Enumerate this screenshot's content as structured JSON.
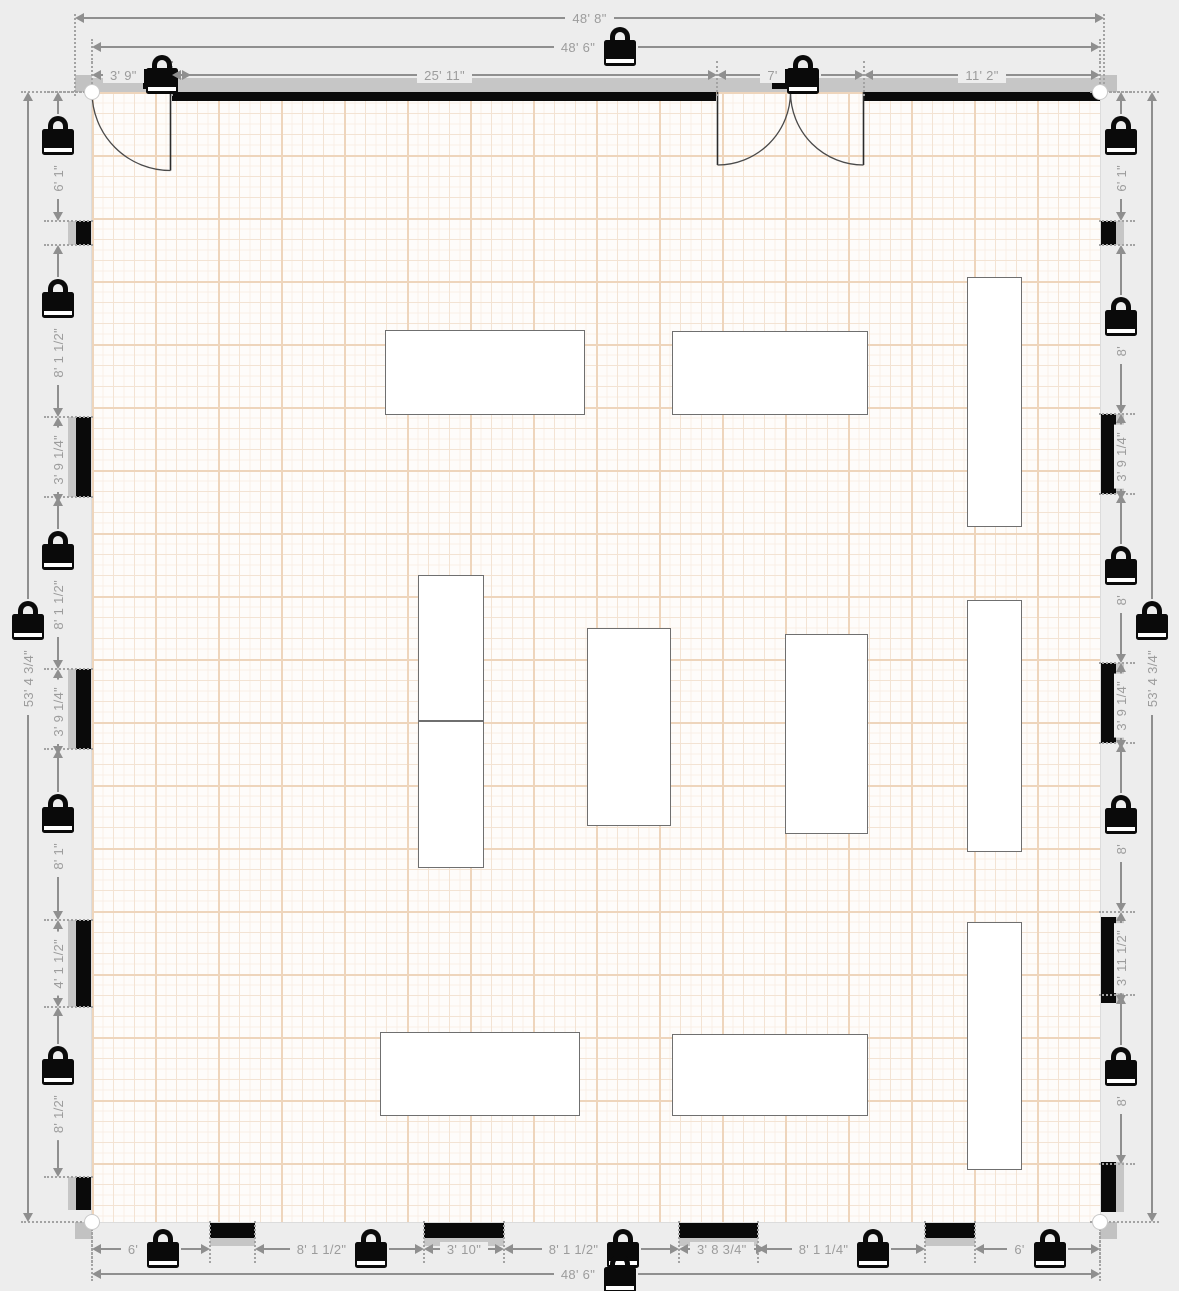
{
  "colors": {
    "background": "#ededed",
    "wall": "#0a0a0a",
    "wall_shadow": "#c6c6c6",
    "dimension_line": "#8f8f8f",
    "dimension_text": "#9c9c9c",
    "floor": "#fefcfa",
    "grid_major": "#eed5bc",
    "grid_minor": "#f3e3d3",
    "grid_fine": "#f9efe7",
    "furniture_fill": "#ffffff",
    "furniture_border": "#6f6f6f",
    "lock_icon": "#0a0a0a"
  },
  "room": {
    "overall_width_outer": "48' 8\"",
    "overall_width_inner": "48' 6\"",
    "overall_height": "53' 4 3/4\"",
    "floor": {
      "x": 92,
      "y": 92,
      "width": 1008,
      "height": 1130
    }
  },
  "dimensions": {
    "top": [
      {
        "label": "48' 8\"",
        "locked": false,
        "a": 75,
        "b": 1104,
        "pos": 18,
        "tick": [
          4,
          78
        ]
      },
      {
        "label": "48' 6\"",
        "locked": true,
        "a": 92,
        "b": 1100,
        "pos": 47,
        "tick": [
          8,
          49
        ]
      },
      {
        "label": "3' 9\"",
        "locked": true,
        "a": 92,
        "b": 172,
        "pos": 75,
        "tick": [
          14,
          21
        ]
      },
      {
        "label": "25' 11\"",
        "locked": false,
        "a": 172,
        "b": 717,
        "pos": 75,
        "tick": [
          14,
          21
        ]
      },
      {
        "label": "7'",
        "locked": true,
        "a": 717,
        "b": 864,
        "pos": 75,
        "tick": [
          14,
          21
        ]
      },
      {
        "label": "11' 2\"",
        "locked": false,
        "a": 864,
        "b": 1100,
        "pos": 75,
        "tick": [
          14,
          21
        ]
      }
    ],
    "bottom": [
      {
        "label": "6'",
        "locked": true,
        "a": 92,
        "b": 210,
        "pos": 1249,
        "tick": [
          28,
          14
        ]
      },
      {
        "label": "8' 1 1/2\"",
        "locked": true,
        "a": 255,
        "b": 424,
        "pos": 1249,
        "tick": [
          28,
          14
        ]
      },
      {
        "label": "3' 10\"",
        "locked": false,
        "a": 424,
        "b": 504,
        "pos": 1249,
        "tick": [
          28,
          14
        ]
      },
      {
        "label": "8' 1 1/2\"",
        "locked": true,
        "a": 504,
        "b": 679,
        "pos": 1249,
        "tick": [
          28,
          14
        ]
      },
      {
        "label": "3' 8 3/4\"",
        "locked": false,
        "a": 679,
        "b": 758,
        "pos": 1249,
        "tick": [
          28,
          14
        ]
      },
      {
        "label": "8' 1 1/4\"",
        "locked": true,
        "a": 758,
        "b": 925,
        "pos": 1249,
        "tick": [
          28,
          14
        ]
      },
      {
        "label": "6'",
        "locked": true,
        "a": 975,
        "b": 1100,
        "pos": 1249,
        "tick": [
          28,
          14
        ]
      },
      {
        "label": "48' 6\"",
        "locked": true,
        "a": 92,
        "b": 1100,
        "pos": 1274,
        "tick": [
          53,
          7
        ]
      }
    ],
    "left": [
      {
        "label": "6' 1\"",
        "locked": true,
        "a": 92,
        "b": 221,
        "pos": 58,
        "tick": [
          14,
          35
        ]
      },
      {
        "label": "8' 1 1/2\"",
        "locked": true,
        "a": 245,
        "b": 417,
        "pos": 58,
        "tick": [
          14,
          35
        ]
      },
      {
        "label": "3' 9 1/4\"",
        "locked": false,
        "a": 417,
        "b": 497,
        "pos": 58,
        "tick": [
          14,
          35
        ]
      },
      {
        "label": "8' 1 1/2\"",
        "locked": true,
        "a": 497,
        "b": 669,
        "pos": 58,
        "tick": [
          14,
          35
        ]
      },
      {
        "label": "3' 9 1/4\"",
        "locked": false,
        "a": 669,
        "b": 749,
        "pos": 58,
        "tick": [
          14,
          35
        ]
      },
      {
        "label": "8' 1\"",
        "locked": true,
        "a": 749,
        "b": 920,
        "pos": 58,
        "tick": [
          14,
          35
        ]
      },
      {
        "label": "4' 1 1/2\"",
        "locked": false,
        "a": 920,
        "b": 1007,
        "pos": 58,
        "tick": [
          14,
          35
        ]
      },
      {
        "label": "8' 1/2\"",
        "locked": true,
        "a": 1007,
        "b": 1177,
        "pos": 58,
        "tick": [
          14,
          35
        ]
      },
      {
        "label": "53' 4 3/4\"",
        "locked": true,
        "a": 92,
        "b": 1222,
        "pos": 28,
        "tick": [
          7,
          65
        ]
      }
    ],
    "right": [
      {
        "label": "6' 1\"",
        "locked": true,
        "a": 92,
        "b": 221,
        "pos": 1121,
        "tick": [
          22,
          14
        ]
      },
      {
        "label": "8'",
        "locked": true,
        "a": 245,
        "b": 414,
        "pos": 1121,
        "tick": [
          22,
          14
        ]
      },
      {
        "label": "3' 9 1/4\"",
        "locked": false,
        "a": 414,
        "b": 494,
        "pos": 1121,
        "tick": [
          22,
          14
        ]
      },
      {
        "label": "8'",
        "locked": true,
        "a": 494,
        "b": 663,
        "pos": 1121,
        "tick": [
          22,
          14
        ]
      },
      {
        "label": "3' 9 1/4\"",
        "locked": false,
        "a": 663,
        "b": 743,
        "pos": 1121,
        "tick": [
          22,
          14
        ]
      },
      {
        "label": "8'",
        "locked": true,
        "a": 743,
        "b": 912,
        "pos": 1121,
        "tick": [
          22,
          14
        ]
      },
      {
        "label": "3' 11 1/2\"",
        "locked": false,
        "a": 912,
        "b": 995,
        "pos": 1121,
        "tick": [
          22,
          14
        ]
      },
      {
        "label": "8'",
        "locked": true,
        "a": 995,
        "b": 1164,
        "pos": 1121,
        "tick": [
          22,
          14
        ]
      },
      {
        "label": "53' 4 3/4\"",
        "locked": true,
        "a": 92,
        "b": 1222,
        "pos": 1152,
        "tick": [
          62,
          7
        ]
      }
    ]
  },
  "walls": {
    "top_band": [
      75,
      78,
      1042,
      14
    ],
    "top_segments": [
      [
        172,
        544
      ],
      [
        864,
        236
      ]
    ],
    "left_piers": [
      [
        221,
        24
      ],
      [
        417,
        80
      ],
      [
        669,
        80
      ],
      [
        920,
        87
      ],
      [
        1177,
        33
      ]
    ],
    "right_piers": [
      [
        221,
        24
      ],
      [
        414,
        80
      ],
      [
        663,
        80
      ],
      [
        917,
        86
      ],
      [
        1162,
        50
      ]
    ],
    "bottom_piers": [
      [
        210,
        45
      ],
      [
        424,
        80
      ],
      [
        679,
        79
      ],
      [
        925,
        50
      ]
    ],
    "corner_blocks": [
      [
        75,
        75
      ],
      [
        1100,
        75
      ],
      [
        75,
        1222
      ],
      [
        1100,
        1222
      ]
    ],
    "corner_handles": [
      [
        92,
        92
      ],
      [
        1100,
        92
      ],
      [
        92,
        1222
      ],
      [
        1100,
        1222
      ]
    ]
  },
  "doors": [
    {
      "type": "single-door",
      "panel": [
        143,
        69,
        28,
        20
      ],
      "lines": [
        [
          170.5,
          92,
          170.5,
          170.5
        ]
      ],
      "arcs": [
        "M92,92 A78.5,78.5 0 0 0 170.5,170.5"
      ]
    },
    {
      "type": "double-door",
      "panel": [
        772,
        69,
        37,
        20
      ],
      "lines": [
        [
          717.5,
          92,
          717.5,
          165
        ],
        [
          863.5,
          92,
          863.5,
          165
        ]
      ],
      "arcs": [
        "M790.5,92 A73,73 0 0 1 717.5,165",
        "M790.5,92 A73,73 0 0 0 863.5,165"
      ]
    }
  ],
  "furniture": [
    {
      "x": 385,
      "y": 330,
      "w": 200,
      "h": 85
    },
    {
      "x": 672,
      "y": 331,
      "w": 196,
      "h": 84
    },
    {
      "x": 967,
      "y": 277,
      "w": 55,
      "h": 250
    },
    {
      "x": 418,
      "y": 575,
      "w": 66,
      "h": 146
    },
    {
      "x": 418,
      "y": 721,
      "w": 66,
      "h": 147
    },
    {
      "x": 587,
      "y": 628,
      "w": 84,
      "h": 198
    },
    {
      "x": 785,
      "y": 634,
      "w": 83,
      "h": 200
    },
    {
      "x": 967,
      "y": 600,
      "w": 55,
      "h": 252
    },
    {
      "x": 380,
      "y": 1032,
      "w": 200,
      "h": 84
    },
    {
      "x": 672,
      "y": 1034,
      "w": 196,
      "h": 82
    },
    {
      "x": 967,
      "y": 922,
      "w": 55,
      "h": 248
    }
  ]
}
